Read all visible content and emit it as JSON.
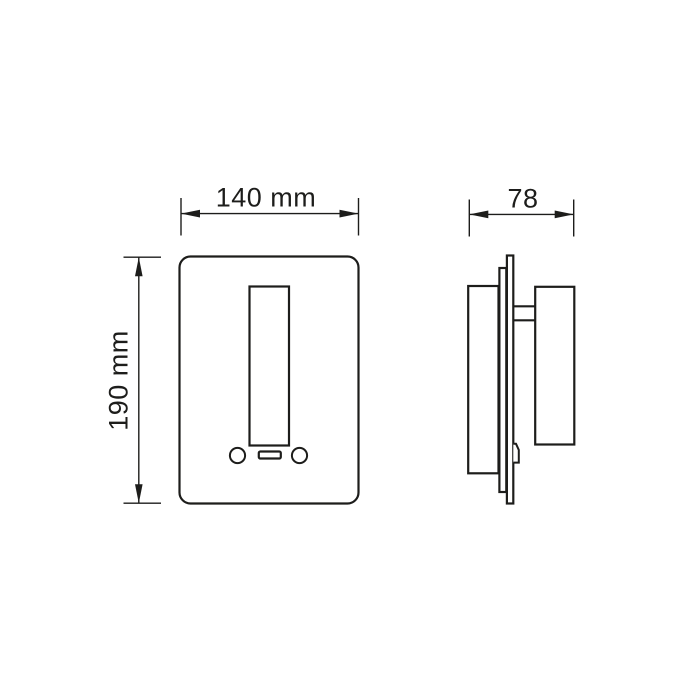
{
  "drawing": {
    "type": "technical-dimension-drawing",
    "subject": "wall-mounted light fixture with switch plate, front and side orthographic views",
    "colors": {
      "line": "#1d1d1b",
      "background": "#ffffff"
    },
    "views": {
      "front": {
        "label": "front-view",
        "width_dim": "140 mm",
        "height_dim": "190 mm",
        "features": [
          "rounded faceplate",
          "vertical light bar",
          "left round button",
          "usb port slot",
          "right round button"
        ]
      },
      "side": {
        "label": "side-view",
        "depth_dim": "78",
        "features": [
          "recessed wall box",
          "back plate",
          "faceplate",
          "mounting arm",
          "lamp head",
          "retention clip"
        ]
      }
    }
  }
}
